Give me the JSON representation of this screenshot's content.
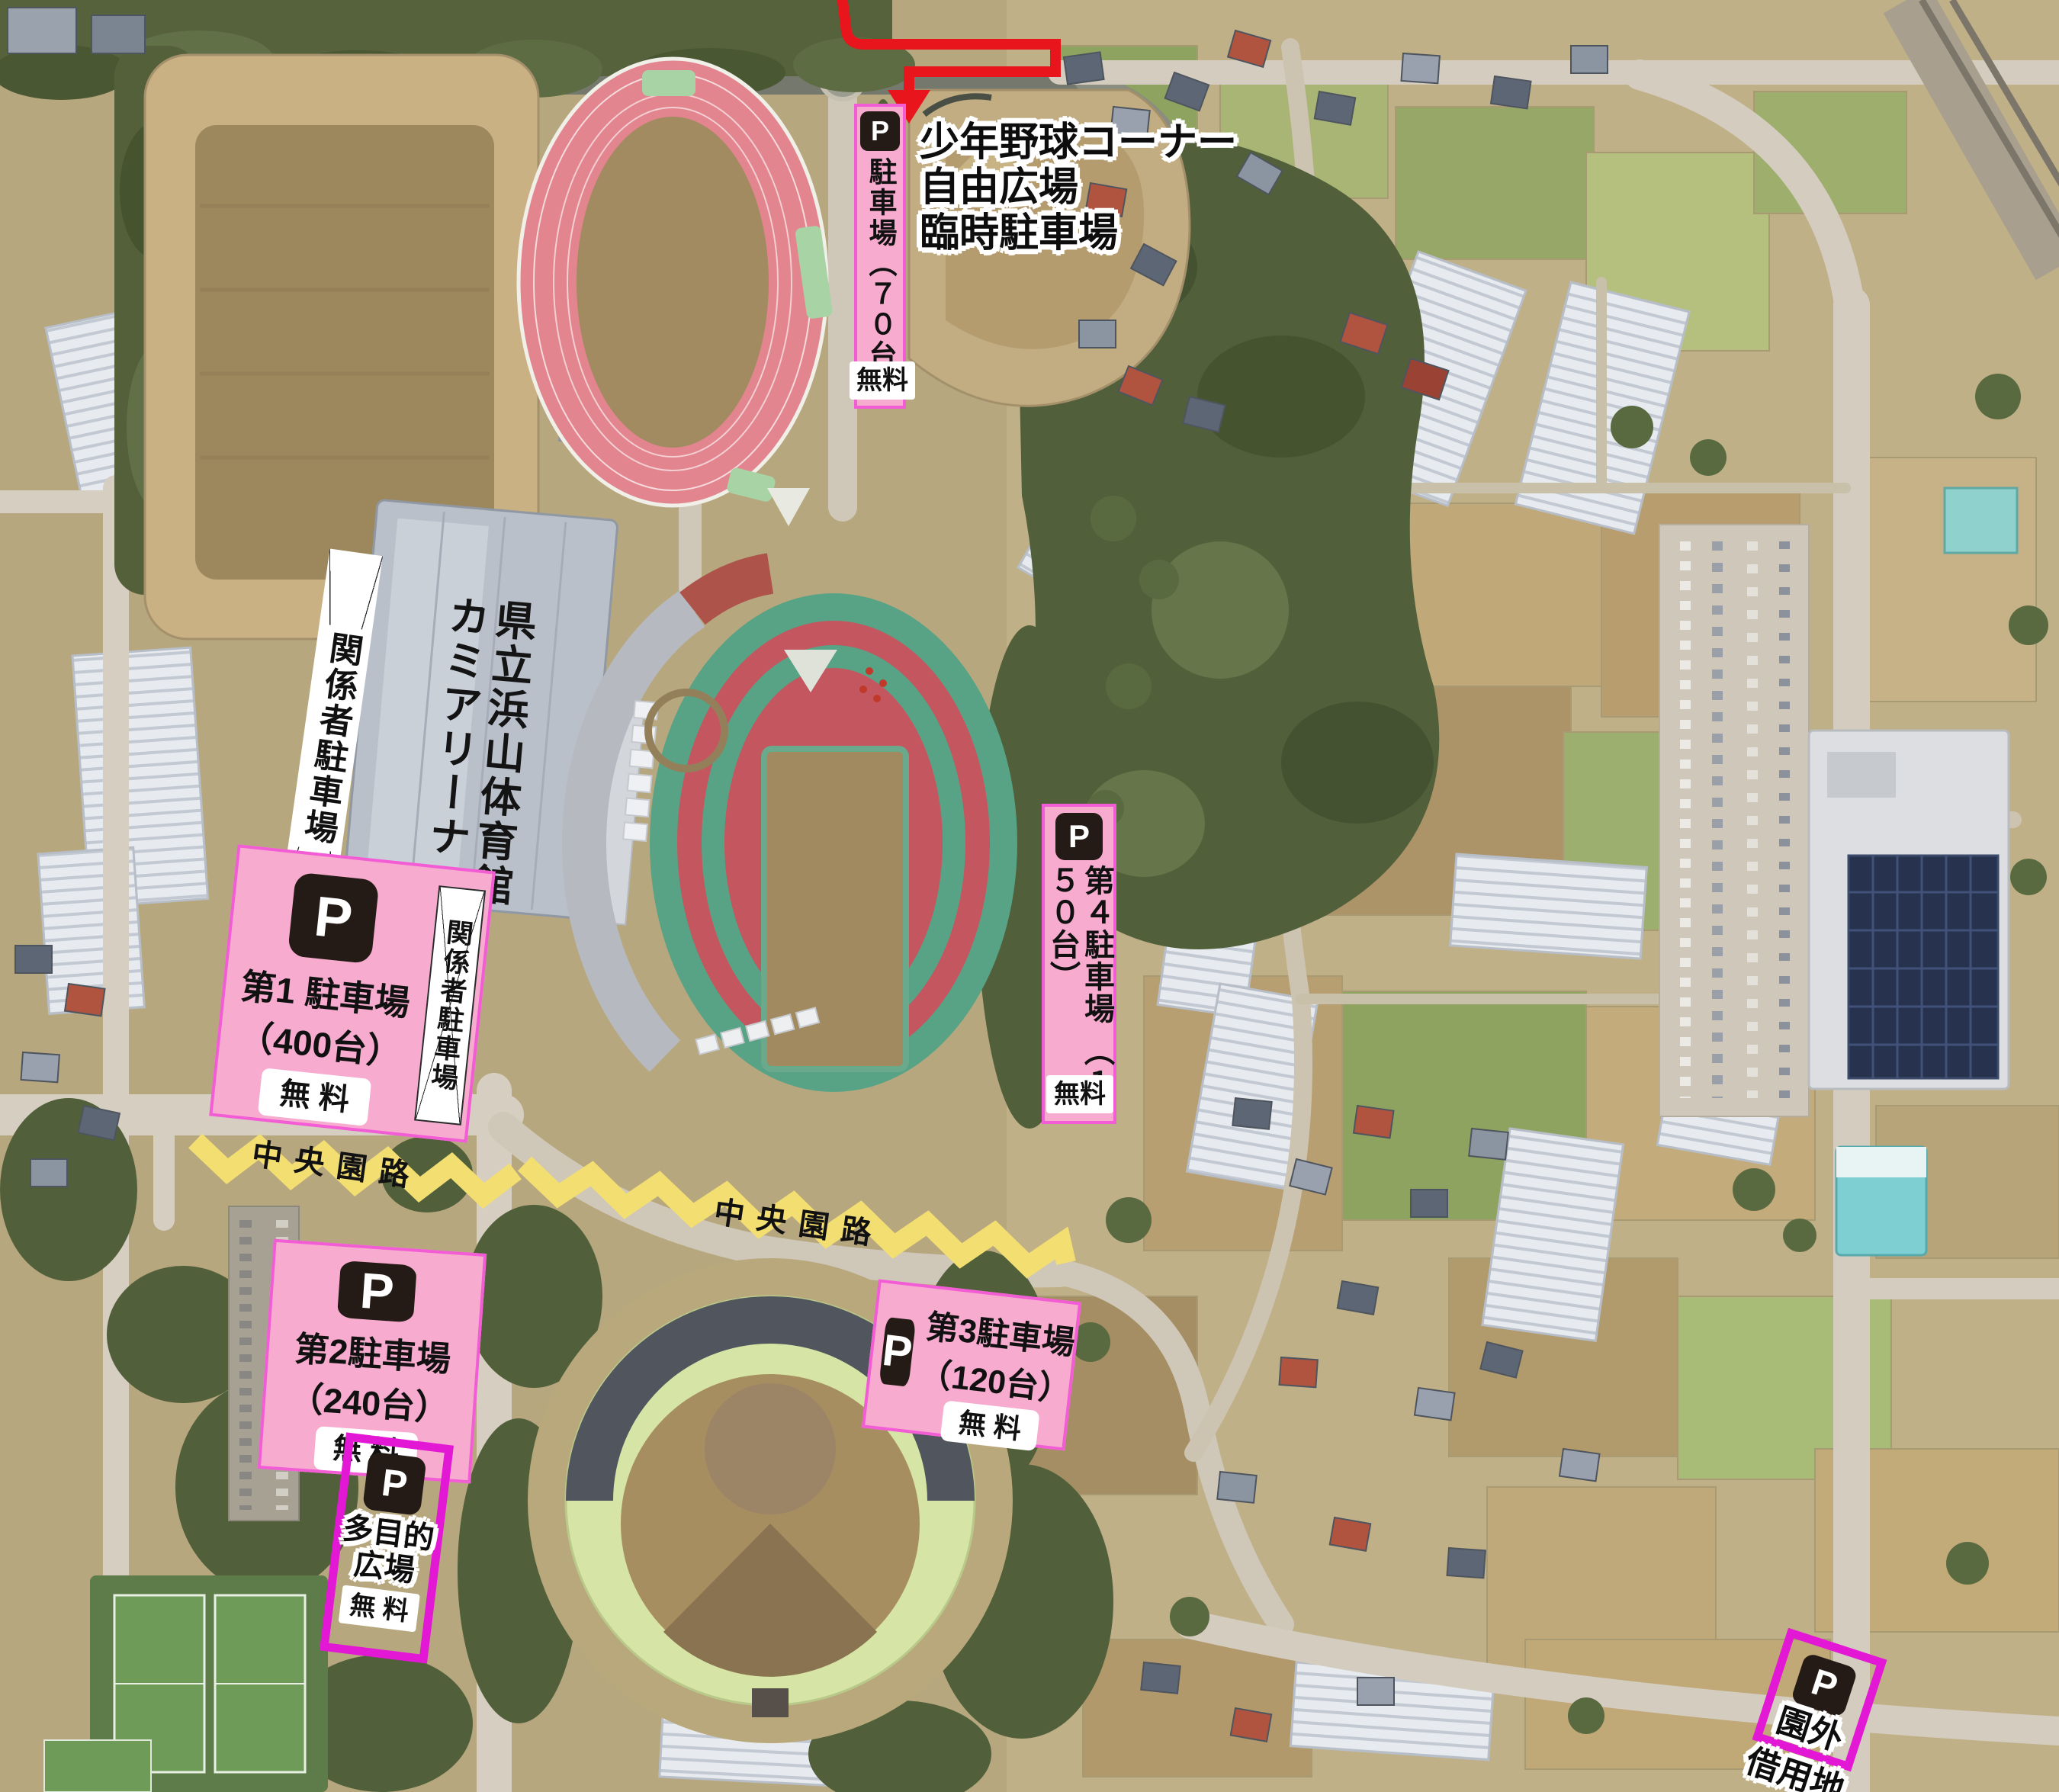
{
  "icons": {
    "p_letter": "P"
  },
  "facilities": {
    "gym_line1": "県立浜山体育館",
    "gym_line2": "カミアリーナ"
  },
  "labels": {
    "staff_parking": "関係者駐車場"
  },
  "roads": {
    "central_park_road": "中央園路"
  },
  "parking": {
    "temporary": {
      "name_vertical": "駐車場（７０台）",
      "fee": "無料",
      "desc_line1": "少年野球コーナー",
      "desc_line2": "自由広場",
      "desc_line3": "臨時駐車場"
    },
    "no1": {
      "name": "第1 駐車場",
      "capacity": "（400台）",
      "fee": "無 料"
    },
    "no2": {
      "name": "第2駐車場",
      "capacity": "（240台）",
      "fee": "無 料"
    },
    "no3": {
      "name": "第3駐車場",
      "capacity": "（120台）",
      "fee": "無 料"
    },
    "no4": {
      "name_col_right": "第４駐車場",
      "name_col_left": "（１５０台）",
      "fee": "無料"
    },
    "multipurpose": {
      "line1": "多目的",
      "line2": "広場",
      "fee": "無 料"
    },
    "outside": {
      "line1": "園外",
      "line2": "借用地"
    }
  },
  "colors": {
    "annotation_pink": "#f7abce",
    "annotation_border": "#f25cd4",
    "outline_magenta": "#e318d4",
    "road_yellow": "#f3de72",
    "route_red": "#e8151d",
    "p_icon_bg": "#241b16"
  }
}
